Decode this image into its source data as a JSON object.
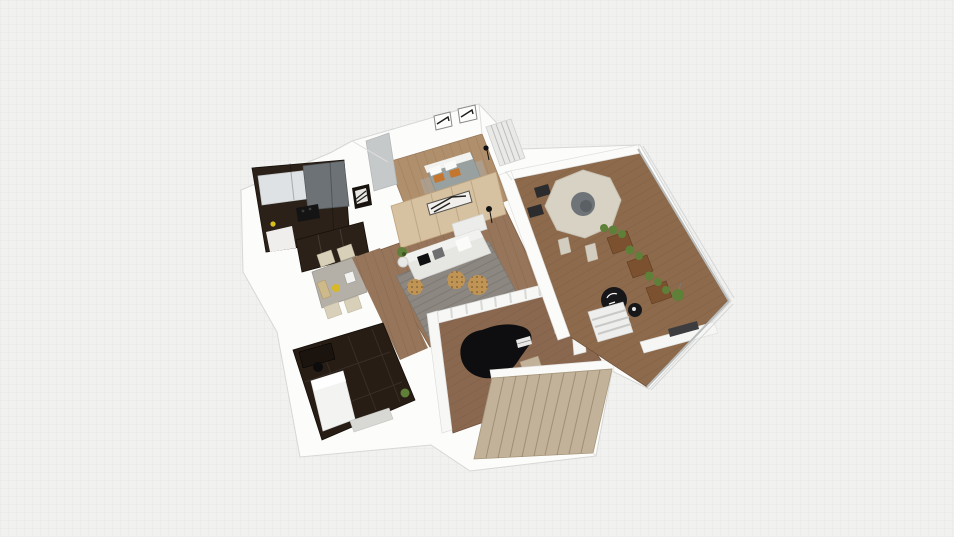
{
  "view": {
    "type": "3d-floorplan-dollhouse-view",
    "description": "Isometric 3D cutaway render of an apartment floor plan on a faint grid canvas",
    "grid_visible": true
  },
  "palette": {
    "background": "#f1f1f0",
    "grid_line": "#e7e7e6",
    "wall_white": "#fcfcfb",
    "wall_edge": "#d7d7d5",
    "wood_floor": "#96755a",
    "wood_floor_light": "#b08f6d",
    "wood_floor_dark": "#8a6850",
    "balcony_floor": "#8d6a4c",
    "accent_wood_wall": "#d6c1a0",
    "dark_cabinet": "#2b2118",
    "dark_room_floor": "#271d15",
    "counter_gray": "#6d7276",
    "upper_cabinet": "#dfe2e4",
    "rug_gray": "#8d8781",
    "sofa_white": "#e6e6e3",
    "bed_duvet": "#99a1a0",
    "pillow_orange": "#c4762f",
    "dining_table_gray": "#b4b0a8",
    "chair_beige": "#d9d0ba",
    "piano_black": "#0e0e10",
    "stairs_beige": "#c2b29a",
    "balcony_table": "#d8d2c4",
    "planter_wood": "#7c5130",
    "plant_green": "#5f8038",
    "pouf_leopard": "#c09455",
    "glass_frame": "#b9bdbd",
    "black_furniture": "#17171a"
  },
  "scene": {
    "rooms": [
      {
        "id": "kitchen",
        "label": "Kitchen"
      },
      {
        "id": "bedroom",
        "label": "Bedroom"
      },
      {
        "id": "living-room",
        "label": "Living Room"
      },
      {
        "id": "dining-nook",
        "label": "Dining Nook"
      },
      {
        "id": "dark-bedroom",
        "label": "Dark Bedroom / Study"
      },
      {
        "id": "piano-room",
        "label": "Piano Room"
      },
      {
        "id": "staircase",
        "label": "Staircase"
      },
      {
        "id": "balcony",
        "label": "Balcony Terrace"
      }
    ],
    "furniture": [
      "double-bed",
      "wall-art-frames",
      "sliding-door-wardrobe",
      "kitchen-cabinets",
      "cooktop",
      "sofa",
      "leopard-poufs",
      "area-rug",
      "tv-console",
      "floor-lamp",
      "dining-table",
      "dining-chairs",
      "grand-piano",
      "piano-bench",
      "round-terrace-table",
      "terrace-chairs",
      "wood-planters",
      "hanging-plant",
      "papasan-chair",
      "ottoman",
      "striped-lounger-steps",
      "desk",
      "office-chair",
      "single-bed",
      "potted-plant"
    ]
  }
}
